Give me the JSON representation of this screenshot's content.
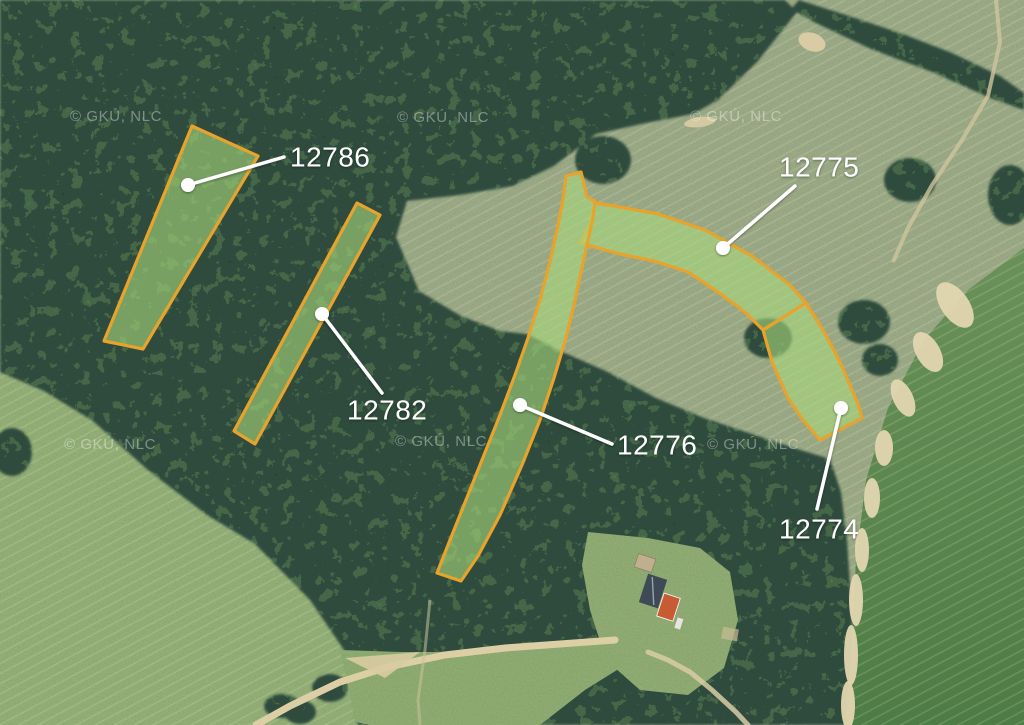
{
  "map": {
    "attribution": "© GKÚ, NLC",
    "overlay": {
      "stroke_color": "#E8A32C",
      "stroke_width": 3.2,
      "fill_color": "#A8D97B",
      "fill_opacity": 0.6,
      "label_color": "#FFFFFF",
      "leader_color": "#FFFFFF"
    },
    "watermarks": [
      {
        "x": 64,
        "y": 449
      },
      {
        "x": 395,
        "y": 446
      },
      {
        "x": 707,
        "y": 449
      },
      {
        "x": 397,
        "y": 122
      },
      {
        "x": 690,
        "y": 121
      },
      {
        "x": 70,
        "y": 121
      }
    ],
    "parcels": [
      {
        "id": "12786",
        "label": "12786",
        "points": "192,126 258,156 143,349 104,341",
        "dot": [
          188,
          185
        ],
        "leader_end": [
          284,
          157
        ],
        "label_anchor": [
          290,
          157
        ]
      },
      {
        "id": "12782",
        "label": "12782",
        "points": "357,203 380,215 255,444 234,431",
        "dot": [
          322,
          314
        ],
        "leader_end": [
          382,
          393
        ],
        "label_anchor": [
          347,
          410
        ]
      },
      {
        "id": "12775",
        "label": "12775",
        "points": "595,203 614,206 658,214 705,230 752,256 790,285 806,303 763,330 745,312 718,292 688,272 654,261 620,254 580,243 590,225",
        "dot": [
          723,
          248
        ],
        "leader_end": [
          795,
          186
        ],
        "label_anchor": [
          779,
          167
        ]
      },
      {
        "id": "12776",
        "label": "12776",
        "points": "566,176 581,172 587,197 595,201 593,218 588,240 581,272 574,305 566,338 554,378 540,420 522,465 500,515 478,556 461,581 437,573 450,540 466,500 484,455 500,415 515,375 528,338 540,300 550,262 558,225 563,200",
        "dot": [
          520,
          405
        ],
        "leader_end": [
          612,
          444
        ],
        "label_anchor": [
          617,
          445
        ]
      },
      {
        "id": "12774",
        "label": "12774",
        "points": "763,330 806,303 823,330 840,362 858,404 862,418 820,440 803,420 788,398 772,362",
        "dot": [
          841,
          408
        ],
        "leader_end": [
          817,
          509
        ],
        "label_anchor": [
          779,
          529
        ]
      }
    ]
  }
}
